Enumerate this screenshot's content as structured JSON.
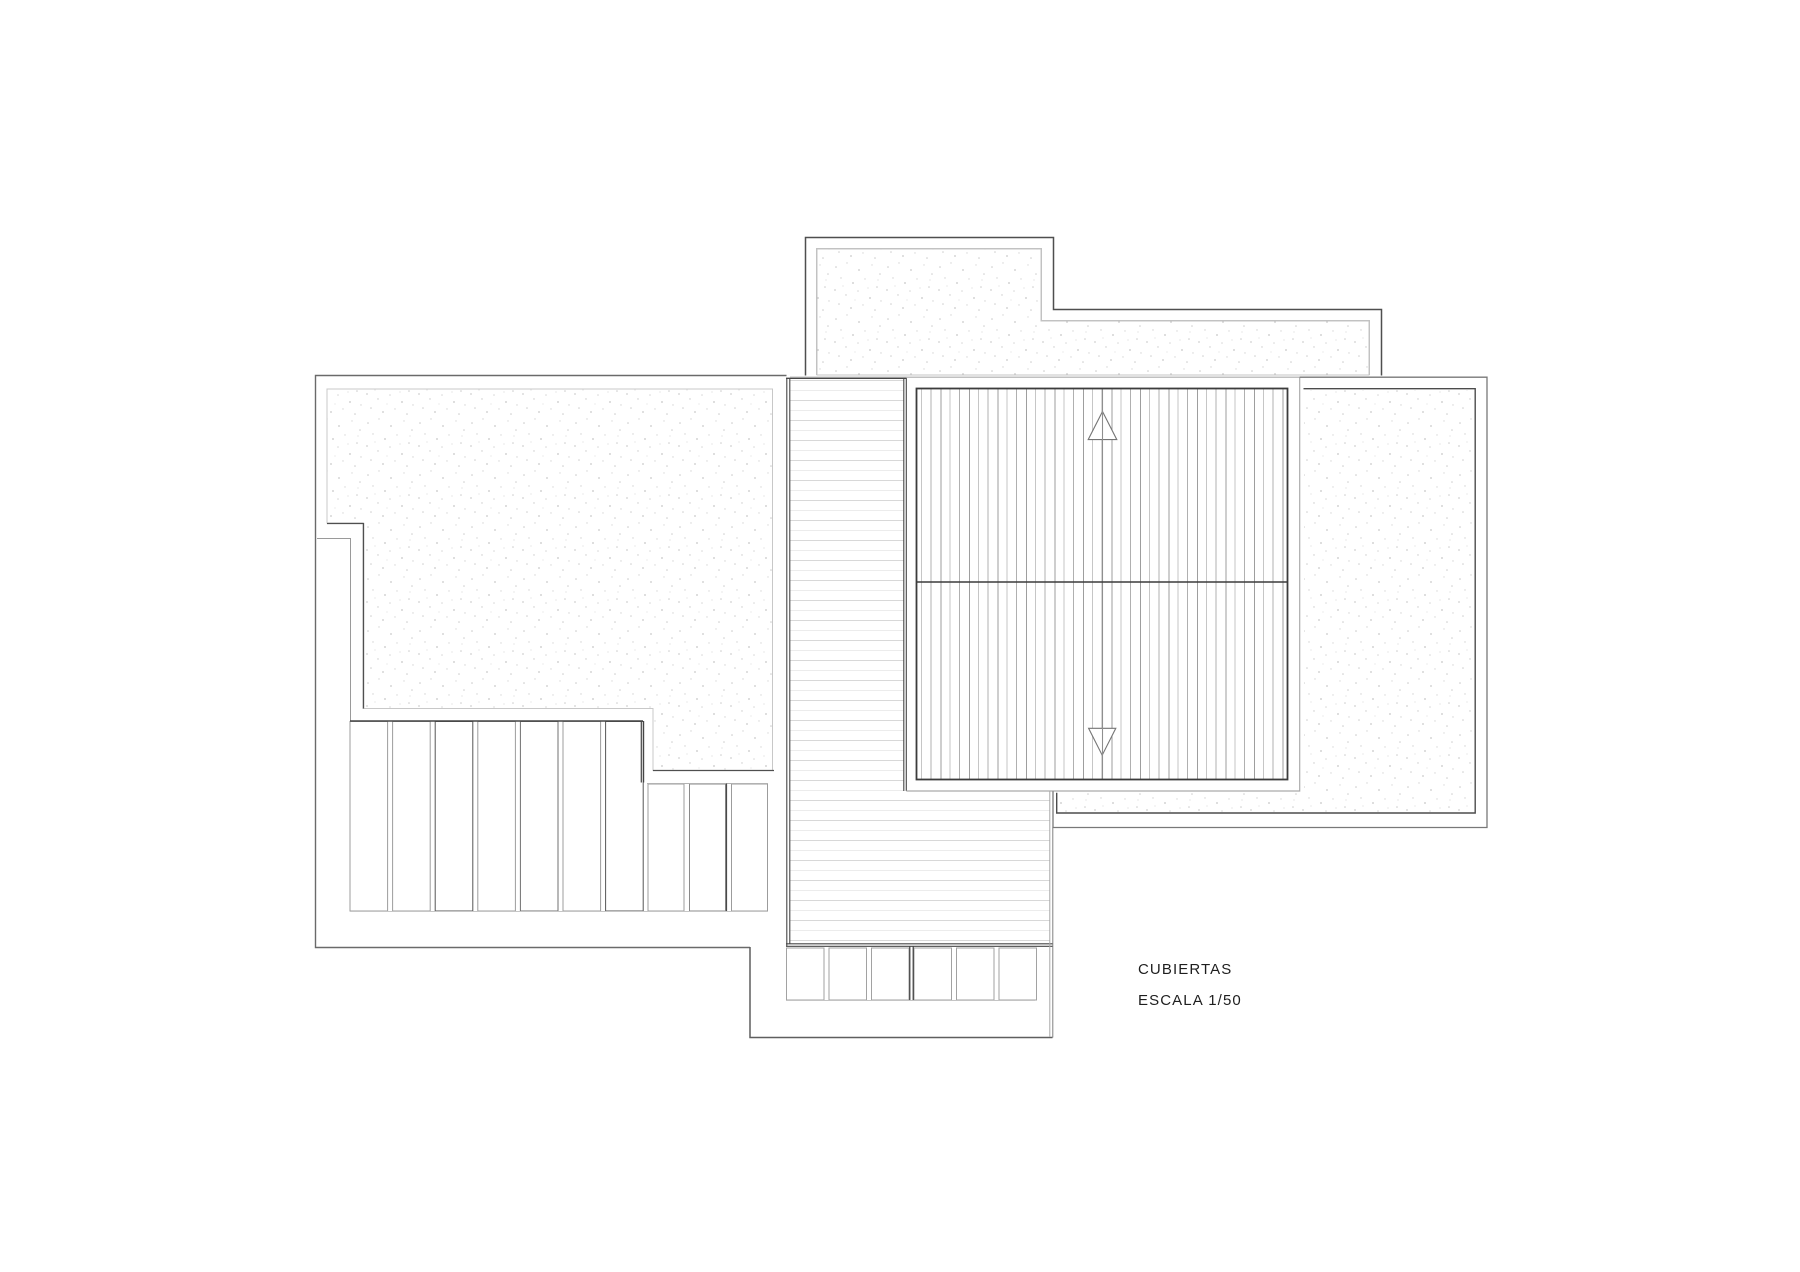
{
  "title_block": {
    "title": "CUBIERTAS",
    "scale": "ESCALA 1/50"
  },
  "drawing": {
    "kind": "architectural roof plan",
    "regions": [
      "upper-roof-terrace",
      "left-roof-terrace",
      "louver-slats-left",
      "deck-walkway-strip",
      "ribbed-roof-panel",
      "right-roof-terrace",
      "louver-slats-bottom"
    ],
    "annotations": {
      "slope_arrow_up": "triangle-up",
      "slope_arrow_down": "triangle-down"
    },
    "colors": {
      "background": "#ffffff",
      "line_dark": "#454545",
      "line_medium": "#8a8a8a",
      "line_light": "#c8c8c8",
      "stipple_dot": "#c9c9c9",
      "deck_line": "#d8d8d8",
      "rib_line": "#a8a8a8",
      "text": "#1e1e1e"
    }
  }
}
